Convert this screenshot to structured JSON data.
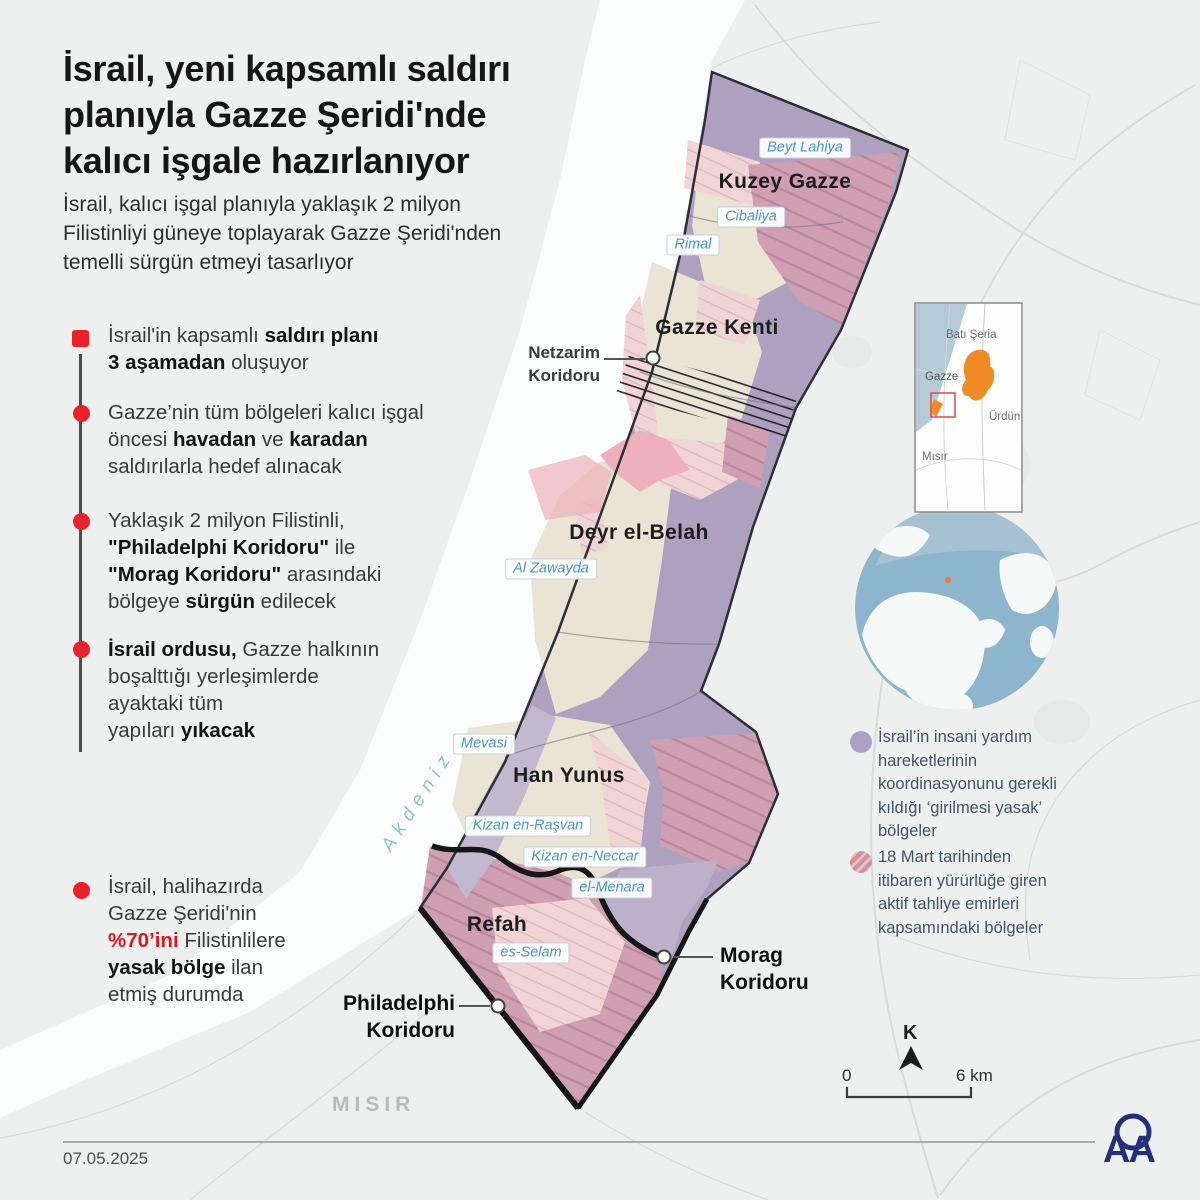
{
  "header": {
    "title": "İsrail, yeni kapsamlı saldırı\nplanıyla Gazze Şeridi'nde\nkalıcı işgale hazırlanıyor",
    "subtitle": "İsrail, kalıcı işgal planıyla yaklaşık 2 milyon\nFilistinliyi güneye toplayarak Gazze Şeridi'nden\ntemelli sürgün etmeyi tasarlıyor"
  },
  "bullets": [
    {
      "runs": [
        {
          "t": "İsrail'in kapsamlı "
        },
        {
          "t": "saldırı planı",
          "s": "b"
        },
        {
          "t": "\n"
        },
        {
          "t": "3 aşamadan",
          "s": "b"
        },
        {
          "t": " oluşuyor"
        }
      ]
    },
    {
      "runs": [
        {
          "t": "Gazze’nin tüm bölgeleri kalıcı işgal\nöncesi "
        },
        {
          "t": "havadan",
          "s": "b"
        },
        {
          "t": " ve "
        },
        {
          "t": "karadan",
          "s": "b"
        },
        {
          "t": "\nsaldırılarla hedef alınacak"
        }
      ]
    },
    {
      "runs": [
        {
          "t": "Yaklaşık 2 milyon Filistinli,\n"
        },
        {
          "t": "\"Philadelphi Koridoru\"",
          "s": "b"
        },
        {
          "t": " ile\n"
        },
        {
          "t": "\"Morag Koridoru\"",
          "s": "b"
        },
        {
          "t": " arasındaki\nbölgeye "
        },
        {
          "t": "sürgün",
          "s": "b"
        },
        {
          "t": " edilecek"
        }
      ]
    },
    {
      "runs": [
        {
          "t": "İsrail ordusu,",
          "s": "b"
        },
        {
          "t": " Gazze halkının\nboşalttığı yerleşimlerde\nayaktaki tüm\nyapıları "
        },
        {
          "t": "yıkacak",
          "s": "b"
        }
      ]
    },
    {
      "runs": [
        {
          "t": "İsrail, halihazırda\nGazze Şeridi'nin\n"
        },
        {
          "t": "%70’ini",
          "s": "r"
        },
        {
          "t": " Filistinlilere\n"
        },
        {
          "t": "yasak bölge",
          "s": "b"
        },
        {
          "t": " ilan\netmiş durumda"
        }
      ]
    }
  ],
  "map": {
    "sea_label": "Akdeniz",
    "country_label": "MISIR",
    "regions": [
      "Kuzey Gazze",
      "Gazze Kenti",
      "Deyr el-Belah",
      "Han Yunus",
      "Refah"
    ],
    "places": [
      "Beyt Lahiya",
      "Cibaliya",
      "Rimal",
      "Al Zawayda",
      "Mevasi",
      "Kizan en-Raşvan",
      "Kizan en-Neccar",
      "el-Menara",
      "es-Selam"
    ],
    "corridors": {
      "netzarim": "Netzarim\nKoridoru",
      "philadelphi": "Philadelphi\nKoridoru",
      "morag": "Morag\nKoridoru"
    }
  },
  "inset": {
    "labels": [
      "Batı Şeria",
      "Gazze",
      "Ürdün",
      "Mısır"
    ]
  },
  "legend": {
    "items": [
      {
        "color": "#aca0c6",
        "text": "İsrail’in insani yardım\nhareketlerinin\nkoordinasyonunu gerekli\nkıldığı ‘girilmesi yasak’\nbölgeler"
      },
      {
        "color": "#cf9097",
        "text": "18 Mart tarihinden\nitibaren yürürlüğe giren\naktif tahliye emirleri\nkapsamındaki bölgeler"
      }
    ]
  },
  "scale": {
    "north": "K",
    "start": "0",
    "end": "6 km"
  },
  "footer": {
    "date": "07.05.2025",
    "logo": "AA"
  },
  "colors": {
    "accent_red": "#e8212b",
    "zone_purple": "#aea1c0",
    "zone_pink_striped": "#cfa0b1",
    "zone_pink_light": "#f1d4d5",
    "label_blue": "#4796c7",
    "logo_navy": "#22307c"
  }
}
